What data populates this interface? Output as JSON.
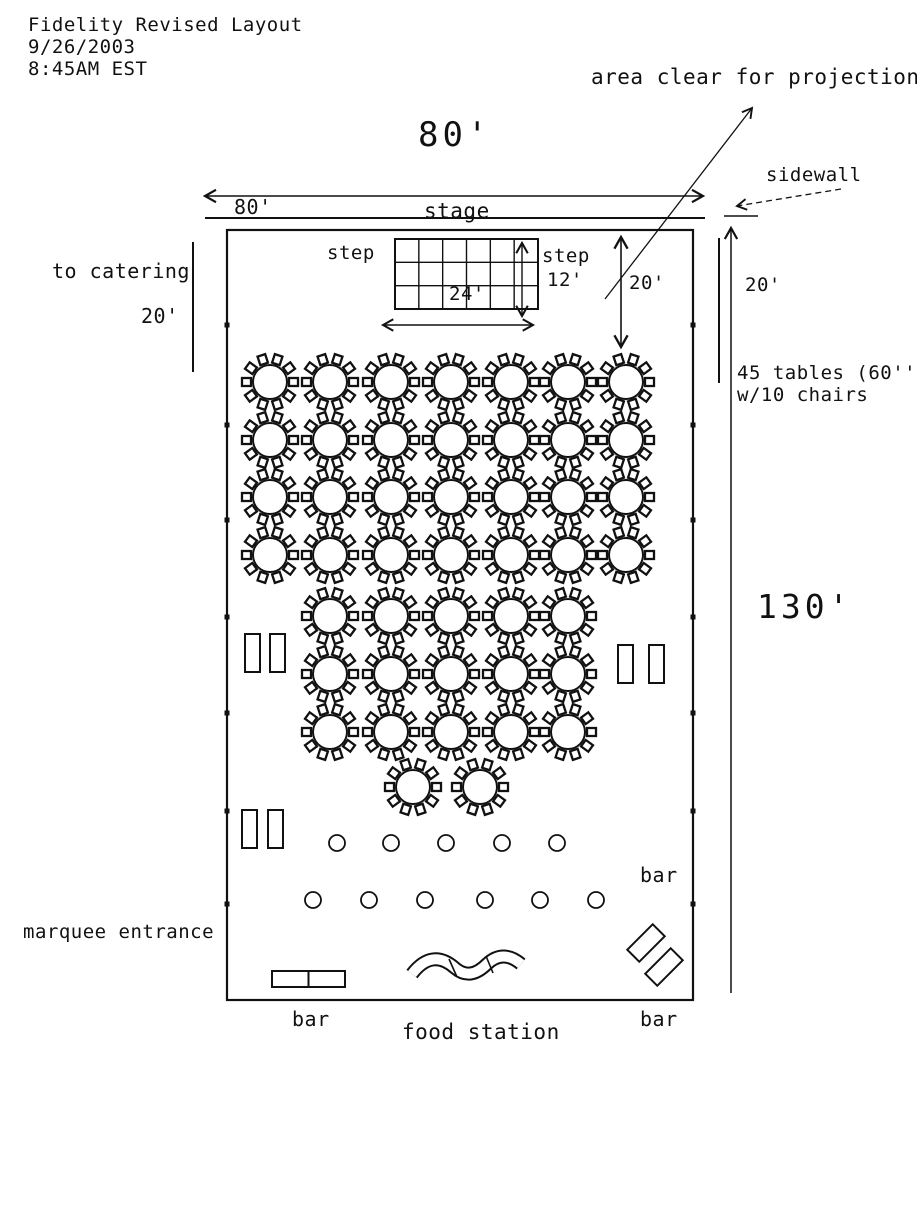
{
  "header": {
    "title": "Fidelity Revised Layout",
    "date": "9/26/2003",
    "time": "8:45AM EST"
  },
  "labels": {
    "area_clear": "area clear for projection",
    "sidewall": "sidewall",
    "stage": "stage",
    "dim_80_big": "80'",
    "dim_80_small": "80'",
    "to_catering": "to catering",
    "catering_20": "20'",
    "step_left": "step",
    "step_right": "step",
    "dim_12": "12'",
    "dim_24": "24'",
    "clear_20": "20'",
    "right_20": "20'",
    "tables_note_1": "45 tables (60''r)",
    "tables_note_2": "w/10 chairs",
    "dim_130": "130'",
    "bar_right": "bar",
    "marquee_entrance": "marquee entrance",
    "bar_bottom_left": "bar",
    "food_station": "food station",
    "bar_bottom_right": "bar"
  },
  "colors": {
    "ink": "#111111",
    "background": "#ffffff"
  },
  "plan": {
    "tent": {
      "x": 227,
      "y": 230,
      "w": 466,
      "h": 770
    },
    "grid": {
      "x": 395,
      "y": 239,
      "w": 143,
      "h": 70,
      "cols": 6,
      "rows": 3
    },
    "table_radius": 17,
    "chair_count": 10,
    "table_rows": [
      {
        "y": 382,
        "xs": [
          270,
          330,
          391,
          451,
          511,
          568,
          626
        ]
      },
      {
        "y": 440,
        "xs": [
          270,
          330,
          391,
          451,
          511,
          568,
          626
        ]
      },
      {
        "y": 497,
        "xs": [
          270,
          330,
          391,
          451,
          511,
          568,
          626
        ]
      },
      {
        "y": 555,
        "xs": [
          270,
          330,
          391,
          451,
          511,
          568,
          626
        ]
      },
      {
        "y": 616,
        "xs": [
          330,
          391,
          451,
          511,
          568
        ]
      },
      {
        "y": 674,
        "xs": [
          330,
          391,
          451,
          511,
          568
        ]
      },
      {
        "y": 732,
        "xs": [
          330,
          391,
          451,
          511,
          568
        ]
      },
      {
        "y": 787,
        "xs": [
          413,
          480
        ]
      }
    ],
    "cocktail_radius": 8,
    "cocktail_rows": [
      {
        "y": 843,
        "xs": [
          337,
          391,
          446,
          502,
          557
        ]
      },
      {
        "y": 900,
        "xs": [
          313,
          369,
          425,
          485,
          540,
          596
        ]
      }
    ],
    "doors": [
      {
        "x": 245,
        "y": 634
      },
      {
        "x": 270,
        "y": 634
      },
      {
        "x": 618,
        "y": 645
      },
      {
        "x": 649,
        "y": 645
      },
      {
        "x": 242,
        "y": 810
      },
      {
        "x": 268,
        "y": 810
      }
    ],
    "door_size": {
      "w": 15,
      "h": 38
    },
    "wall_tick_ys": [
      325,
      425,
      520,
      617,
      713,
      811,
      904
    ]
  }
}
